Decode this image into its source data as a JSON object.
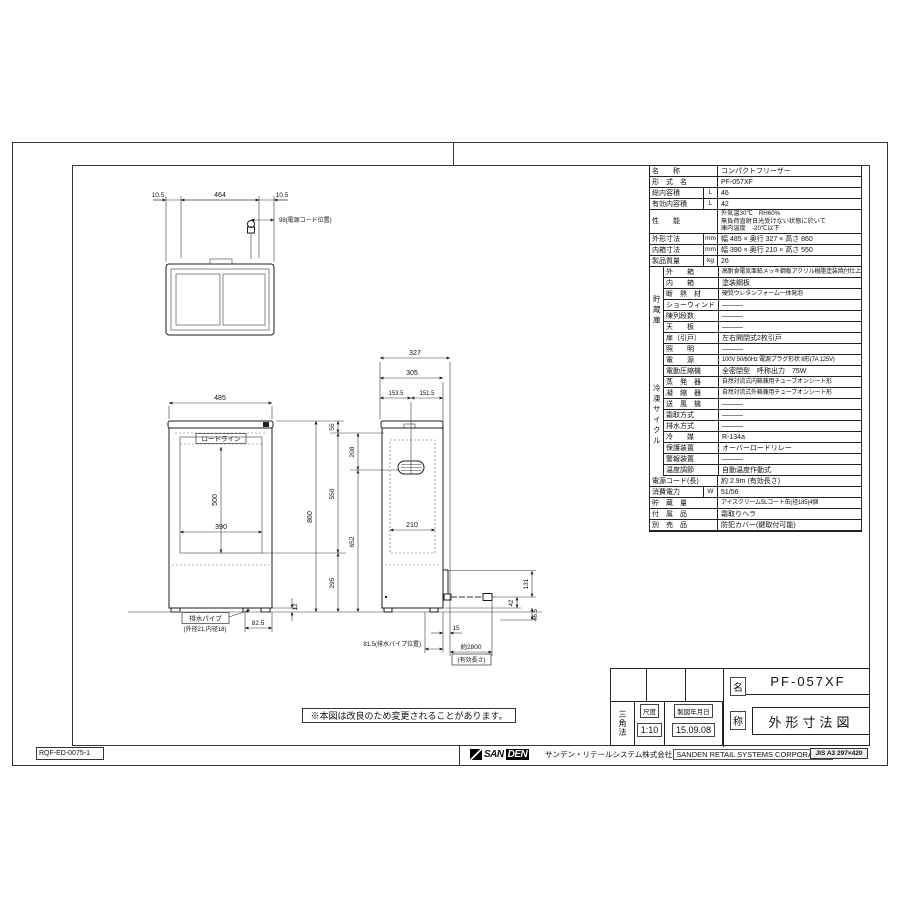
{
  "sheet": {
    "doc_number": "RQF-ED-0075-1",
    "note": "※本図は改良のため変更されることがあります。",
    "format_label": "JIS A3 297×420",
    "logo_text_1": "SAN",
    "logo_text_2": "DEN",
    "company_jp": "サンデン・リテールシステム株式会社",
    "company_en": "SANDEN RETAIL SYSTEMS CORPORATION"
  },
  "title_block": {
    "projection": "三角法",
    "scale_label": "尺度",
    "scale_value": "1:10",
    "date_label": "製図年月日",
    "date_value": "15.09.08",
    "name_char_1": "名",
    "name_char_2": "称",
    "model": "PF-057XF",
    "drawing_title": "外形寸法図"
  },
  "spec": {
    "name": {
      "label": "名　　称",
      "value": "コンパクトフリーザー"
    },
    "model": {
      "label": "形　式　名",
      "value": "PF-057XF"
    },
    "gross_volume": {
      "label": "総内容積",
      "unit": "L",
      "value": "46"
    },
    "effective_volume": {
      "label": "有効内容積",
      "unit": "L",
      "value": "42"
    },
    "performance": {
      "label": "性　　能",
      "line1": "外気温30℃　RH60%",
      "line2": "無負荷直射日光受けない状態に於いて",
      "line3": "庫内温度　-20℃以下"
    },
    "external_dims": {
      "label": "外形寸法",
      "unit": "mm",
      "value": "幅 485 × 奥行 327 × 高さ 860"
    },
    "internal_dims": {
      "label": "内箱寸法",
      "unit": "mm",
      "value": "幅 390 × 奥行 210 × 高さ 550"
    },
    "weight": {
      "label": "製品質量",
      "unit": "kg",
      "value": "26"
    },
    "storage_group": "貯蔵庫",
    "outer_case": {
      "label": "外　　箱",
      "value": "高耐食電気亜鉛メッキ鋼板アクリル樹脂塗装焼付仕上げ"
    },
    "inner_case": {
      "label": "内　　箱",
      "value": "塗装鋼板"
    },
    "insulation": {
      "label": "断　熱　材",
      "value": "硬質ウレタンフォーム一体発泡"
    },
    "show_window": {
      "label": "ショーウィンド",
      "value": "―――"
    },
    "shelves": {
      "label": "陳列段数",
      "value": "―――"
    },
    "top_plate": {
      "label": "天　　板",
      "value": "―――"
    },
    "door": {
      "label": "扉（引戸）",
      "value": "左右開閉式2枚引戸"
    },
    "lighting": {
      "label": "照　　明",
      "value": "―――"
    },
    "cycle_group": "冷凍サイクル",
    "power": {
      "label": "電　　源",
      "value": "100V 50/60Hz 電源プラグ形状 Ⅱ形(7A 125V)"
    },
    "compressor": {
      "label": "電動圧縮機",
      "value": "全密閉型　呼称出力　75W"
    },
    "evaporator": {
      "label": "蒸　発　器",
      "value": "自然対流式内箱兼用チューブオンシート形"
    },
    "condenser": {
      "label": "凝　縮　器",
      "value": "自然対流式外箱兼用チューブオンシート形"
    },
    "fan": {
      "label": "送　風　機",
      "value": "―――"
    },
    "defrost": {
      "label": "霜取方式",
      "value": "―――"
    },
    "drainage": {
      "label": "排水方式",
      "value": "―――"
    },
    "refrigerant": {
      "label": "冷　　媒",
      "value": "R-134a"
    },
    "protection": {
      "label": "保護装置",
      "value": "オーバーロードリレー"
    },
    "alarm": {
      "label": "警報装置",
      "value": "―――"
    },
    "thermostat": {
      "label": "温度調節",
      "value": "自動温度作動式"
    },
    "cord": {
      "label": "電源コード(長)",
      "value": "約 2.9m (有効長さ)"
    },
    "consumption": {
      "label": "消費電力",
      "unit": "W",
      "value": "51/56"
    },
    "capacity": {
      "label": "貯　蔵　量",
      "value": "アイスクリーム5Lコート缶(径185)4個"
    },
    "accessories": {
      "label": "付　属　品",
      "value": "霜取りヘラ"
    },
    "options": {
      "label": "別　売　品",
      "value": "防犯カバー(鍵取付可能)"
    }
  },
  "drawing": {
    "top_view": {
      "dim_margin_left": "10.5",
      "dim_lid_width": "464",
      "dim_margin_right": "10.5",
      "cord_position": "98(電源コード位置)"
    },
    "front_view": {
      "dim_width": "485",
      "load_line_label": "ロードライン",
      "dim_inner_width": "390",
      "dim_inner_height": "500",
      "dim_height": "860",
      "dim_drain_offset": "82.5",
      "dim_foot_height": "12",
      "drain_pipe_label": "排水パイプ",
      "drain_pipe_size": "(外径21,内径18)"
    },
    "side_view": {
      "dim_depth": "327",
      "dim_lid_depth": "305",
      "dim_center_front": "153.5",
      "dim_center_rear": "151.5",
      "dim_lid_height": "55",
      "dim_evap_center": "208",
      "dim_inner_height": "550",
      "dim_evap_to_floor": "652",
      "dim_lower_height": "295",
      "dim_inner_depth": "210",
      "dim_cord_height": "131",
      "dim_cord_drop": "42",
      "dim_cord_floor": "46.5",
      "dim_cord_offset": "15",
      "drain_pipe_position": "81.5(排水パイプ位置)",
      "cord_length": "約2800",
      "cord_length_note": "(有効長さ)"
    }
  }
}
